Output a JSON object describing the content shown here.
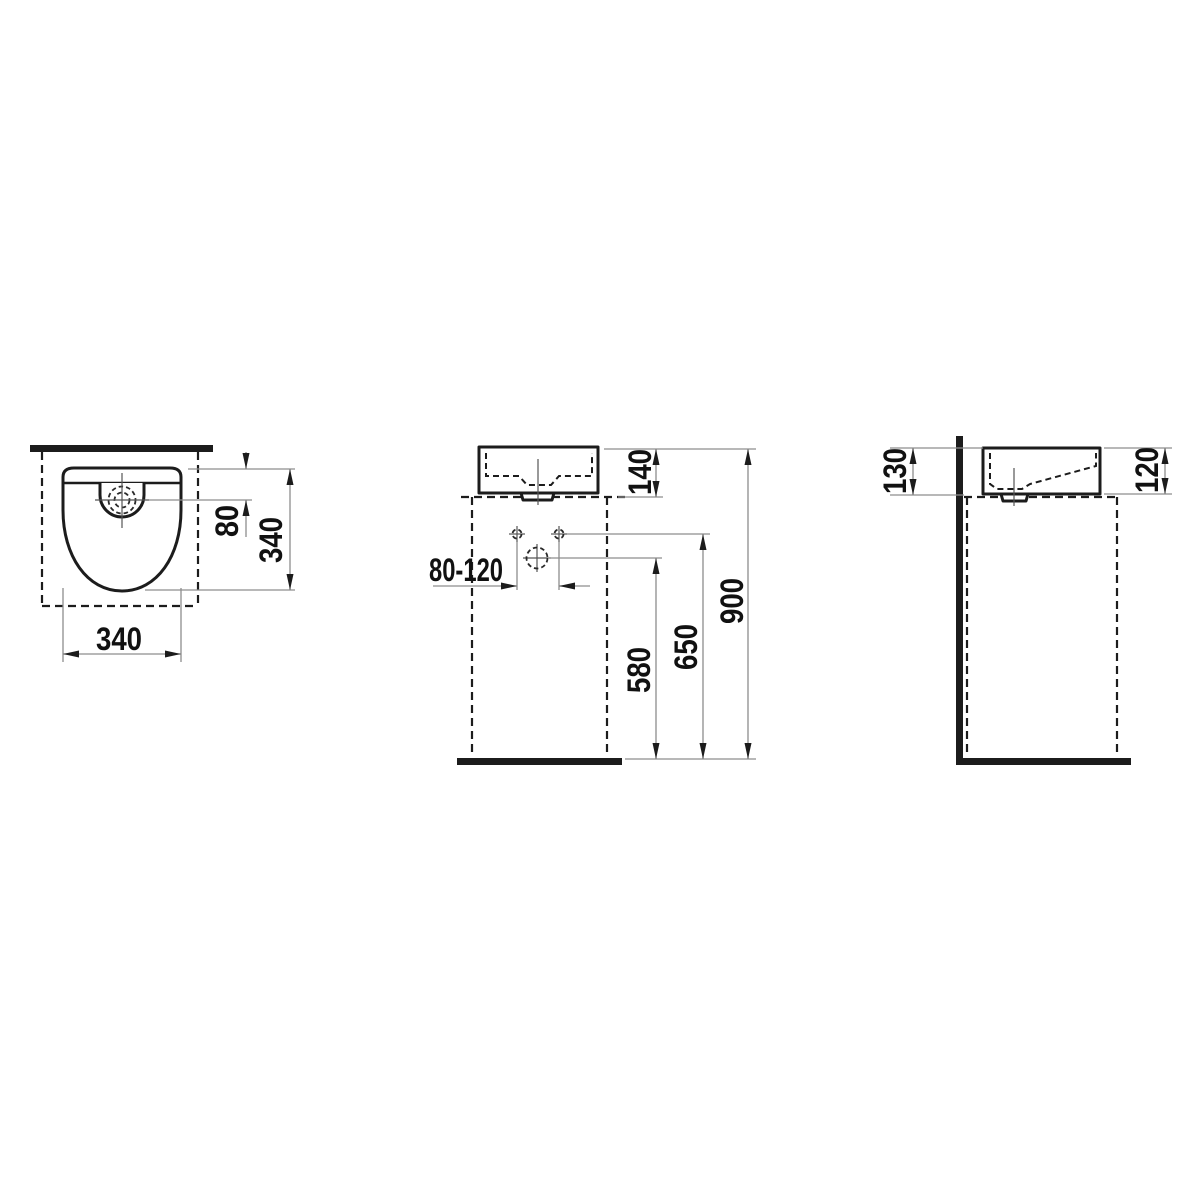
{
  "drawing": {
    "background_color": "#ffffff",
    "object_line_color": "#1c1c1c",
    "dimension_line_color": "#8d8d8d",
    "views": {
      "top_view": {
        "dims": {
          "tap_offset": "80",
          "overall_depth": "340",
          "overall_width": "340"
        }
      },
      "front_view": {
        "dims": {
          "basin_height": "140",
          "supply_spacing": "80-120",
          "drain_height": "580",
          "supply_height": "650",
          "rim_height": "900"
        }
      },
      "side_view": {
        "dims": {
          "back_height": "130",
          "front_height": "120"
        }
      }
    }
  }
}
